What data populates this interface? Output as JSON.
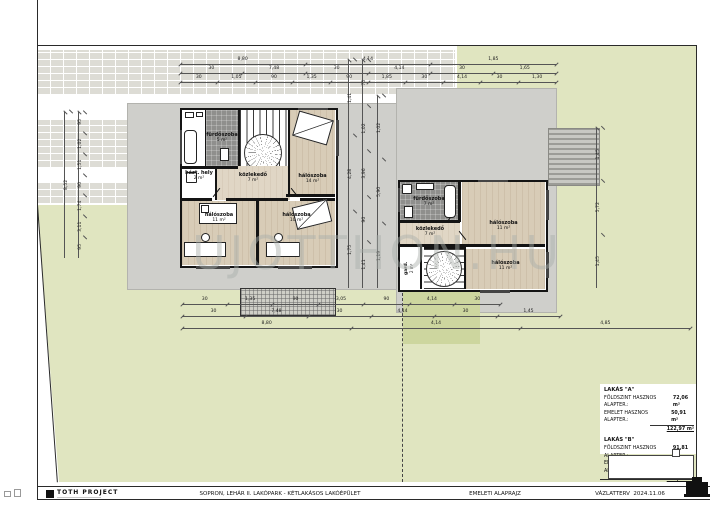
{
  "watermark": "UJOTTHON.HU",
  "titlebar": {
    "firm": "TOTH PROJECT",
    "project": "SOPRON, LEHÁR II. LAKÓPARK - KÉTLAKÁSOS LAKÓÉPÜLET",
    "drawing": "EMELETI ALAPRAJZ",
    "status": "VÁZLATTERV",
    "date": "2024.11.06"
  },
  "legend": {
    "unit_a": {
      "title": "LAKÁS \"A\"",
      "rows": [
        {
          "label": "FÖLDSZINT HASZNOS ALAPTER.:",
          "value": "72,06 m²"
        },
        {
          "label": "EMELET HASZNOS ALAPTER.:",
          "value": "50,91 m²"
        }
      ],
      "total": "122,97 m²"
    },
    "unit_b": {
      "title": "LAKÁS \"B\"",
      "rows": [
        {
          "label": "FÖLDSZINT HASZNOS ALAPTER.:",
          "value": "91,81 m²"
        },
        {
          "label": "EMELET HASZNOS ALAPTER.:",
          "value": "35,70 m²"
        }
      ],
      "total": "127,51 m²"
    }
  },
  "building_a": {
    "rooms": [
      {
        "name": "fürdőszoba",
        "area": "5 m²"
      },
      {
        "name": "házt. hely",
        "area": "2 m²"
      },
      {
        "name": "közlekedő",
        "area": "7 m²"
      },
      {
        "name": "hálószoba",
        "area": "14 m²"
      },
      {
        "name": "hálószoba",
        "area": "11 m²"
      },
      {
        "name": "hálószoba",
        "area": "10 m²"
      }
    ]
  },
  "building_b": {
    "rooms": [
      {
        "name": "fürdőszoba",
        "area": "7 m²"
      },
      {
        "name": "közlekedő",
        "area": "7 m²"
      },
      {
        "name": "gard.",
        "area": "2 m²"
      },
      {
        "name": "hálószoba",
        "area": "11 m²"
      },
      {
        "name": "hálószoba",
        "area": "11 m²"
      }
    ]
  },
  "dims": {
    "top1": [
      "8,80",
      "4,14",
      "1,85"
    ],
    "top2": [
      "30",
      "7,48",
      "30",
      "4,14",
      "30",
      "1,65"
    ],
    "top3": [
      "30",
      "1,05",
      "90",
      "1,35",
      "90",
      "1,85",
      "30",
      "4,14",
      "30",
      "1,30"
    ],
    "bottom1": [
      "30",
      "1,35",
      "90",
      "3,05",
      "90",
      "4,14",
      "30"
    ],
    "bottom2": [
      "30",
      "7,48",
      "30",
      "4,14",
      "30",
      "1,45"
    ],
    "bottom3": [
      "8,80",
      "4,14",
      "4,85"
    ],
    "left1": [
      "8,52"
    ],
    "left2": [
      "95",
      "1,02",
      "1,51",
      "90",
      "1,74",
      "3,11",
      "95"
    ],
    "mid1": [
      "1,41",
      "4,28",
      "1,75"
    ],
    "mid2": [
      "75",
      "1,02",
      "3,96",
      "90",
      "1,41"
    ],
    "mid3": [
      "1,02",
      "5,90",
      "1,19"
    ],
    "right1": [
      "1,45",
      "5,72",
      "1,45"
    ]
  },
  "colors": {
    "grass": "#e0e5c0",
    "grass_dark": "#cdd69f",
    "slab": "#cfcfcb",
    "wall": "#141414",
    "wood_floor": "#d8ccb7",
    "tile_floor": "#8f8f8d",
    "paper": "#ffffff"
  }
}
